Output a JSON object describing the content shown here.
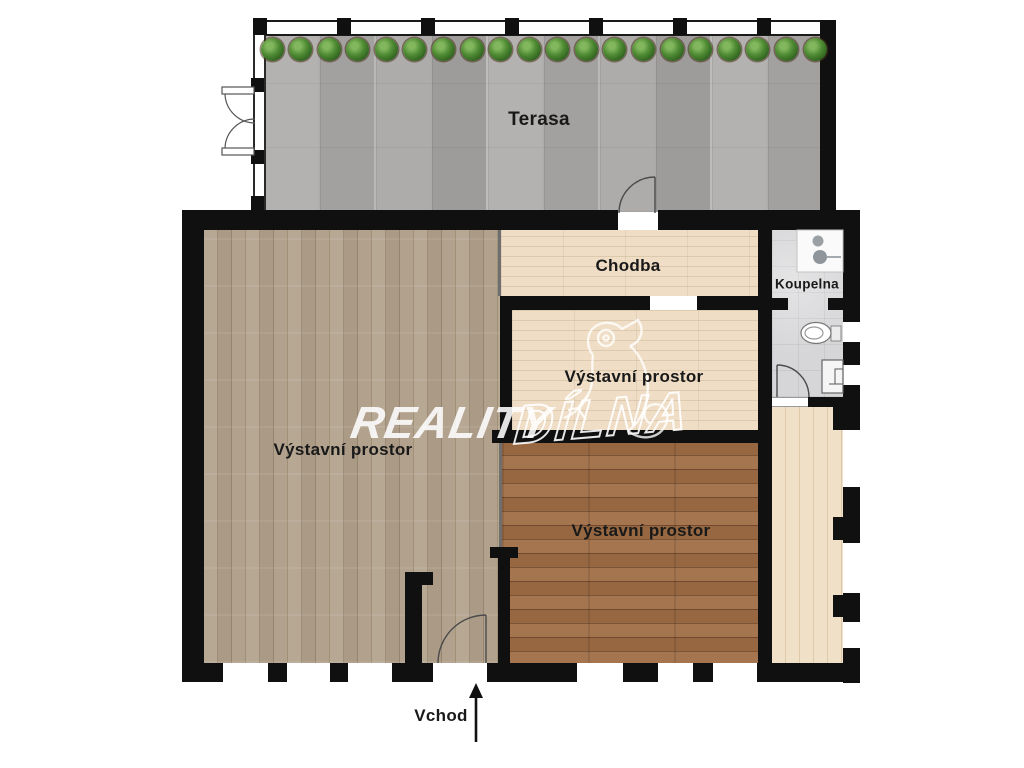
{
  "watermark": {
    "text_solid": "REALITY",
    "text_outline": "DÍLNA",
    "mascot": "chameleon-outline"
  },
  "labels": {
    "terasa": "Terasa",
    "chodba": "Chodba",
    "koupelna": "Koupelna",
    "exhibition_left": "Výstavní prostor",
    "exhibition_middle": "Výstavní prostor",
    "exhibition_bottom": "Výstavní prostor",
    "entrance": "Vchod"
  },
  "terrace": {
    "plant_count": 20
  },
  "colors": {
    "wall": "#101010",
    "terrace_floor": "#a9a8a6",
    "exhibition_left_floor": "#ab9b87",
    "light_wood_floor": "#ead7bd",
    "dark_wood_floor": "#9a6b47",
    "strip_floor": "#ecd9c0",
    "bathroom_floor": "#d6d6d8",
    "plant_green": "#4e8a33",
    "watermark_white": "#ffffff"
  }
}
